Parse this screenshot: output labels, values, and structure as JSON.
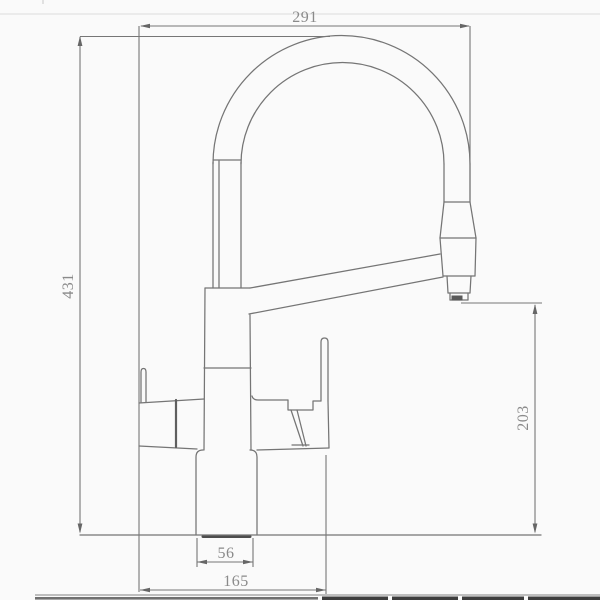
{
  "diagram": {
    "kind": "technical dimension drawing",
    "subject": "kitchen faucet with arched flexible spout, side view",
    "colors": {
      "background": "#fafafa",
      "drawing_line": "#747474",
      "dimension_text": "#8a8a8a",
      "dark_accent": "#4d4d4d",
      "table_edge_dark": "#3c3c3c"
    },
    "dimensions": {
      "spout_reach_top": {
        "value": "291",
        "orientation": "horizontal",
        "position": "top"
      },
      "overall_height_left": {
        "value": "431",
        "orientation": "vertical",
        "position": "left"
      },
      "outlet_height_right": {
        "value": "203",
        "orientation": "vertical",
        "position": "right"
      },
      "body_width_bottom": {
        "value": "56",
        "orientation": "horizontal",
        "position": "bottom"
      },
      "base_span_bottom": {
        "value": "165",
        "orientation": "horizontal",
        "position": "bottom"
      }
    }
  }
}
